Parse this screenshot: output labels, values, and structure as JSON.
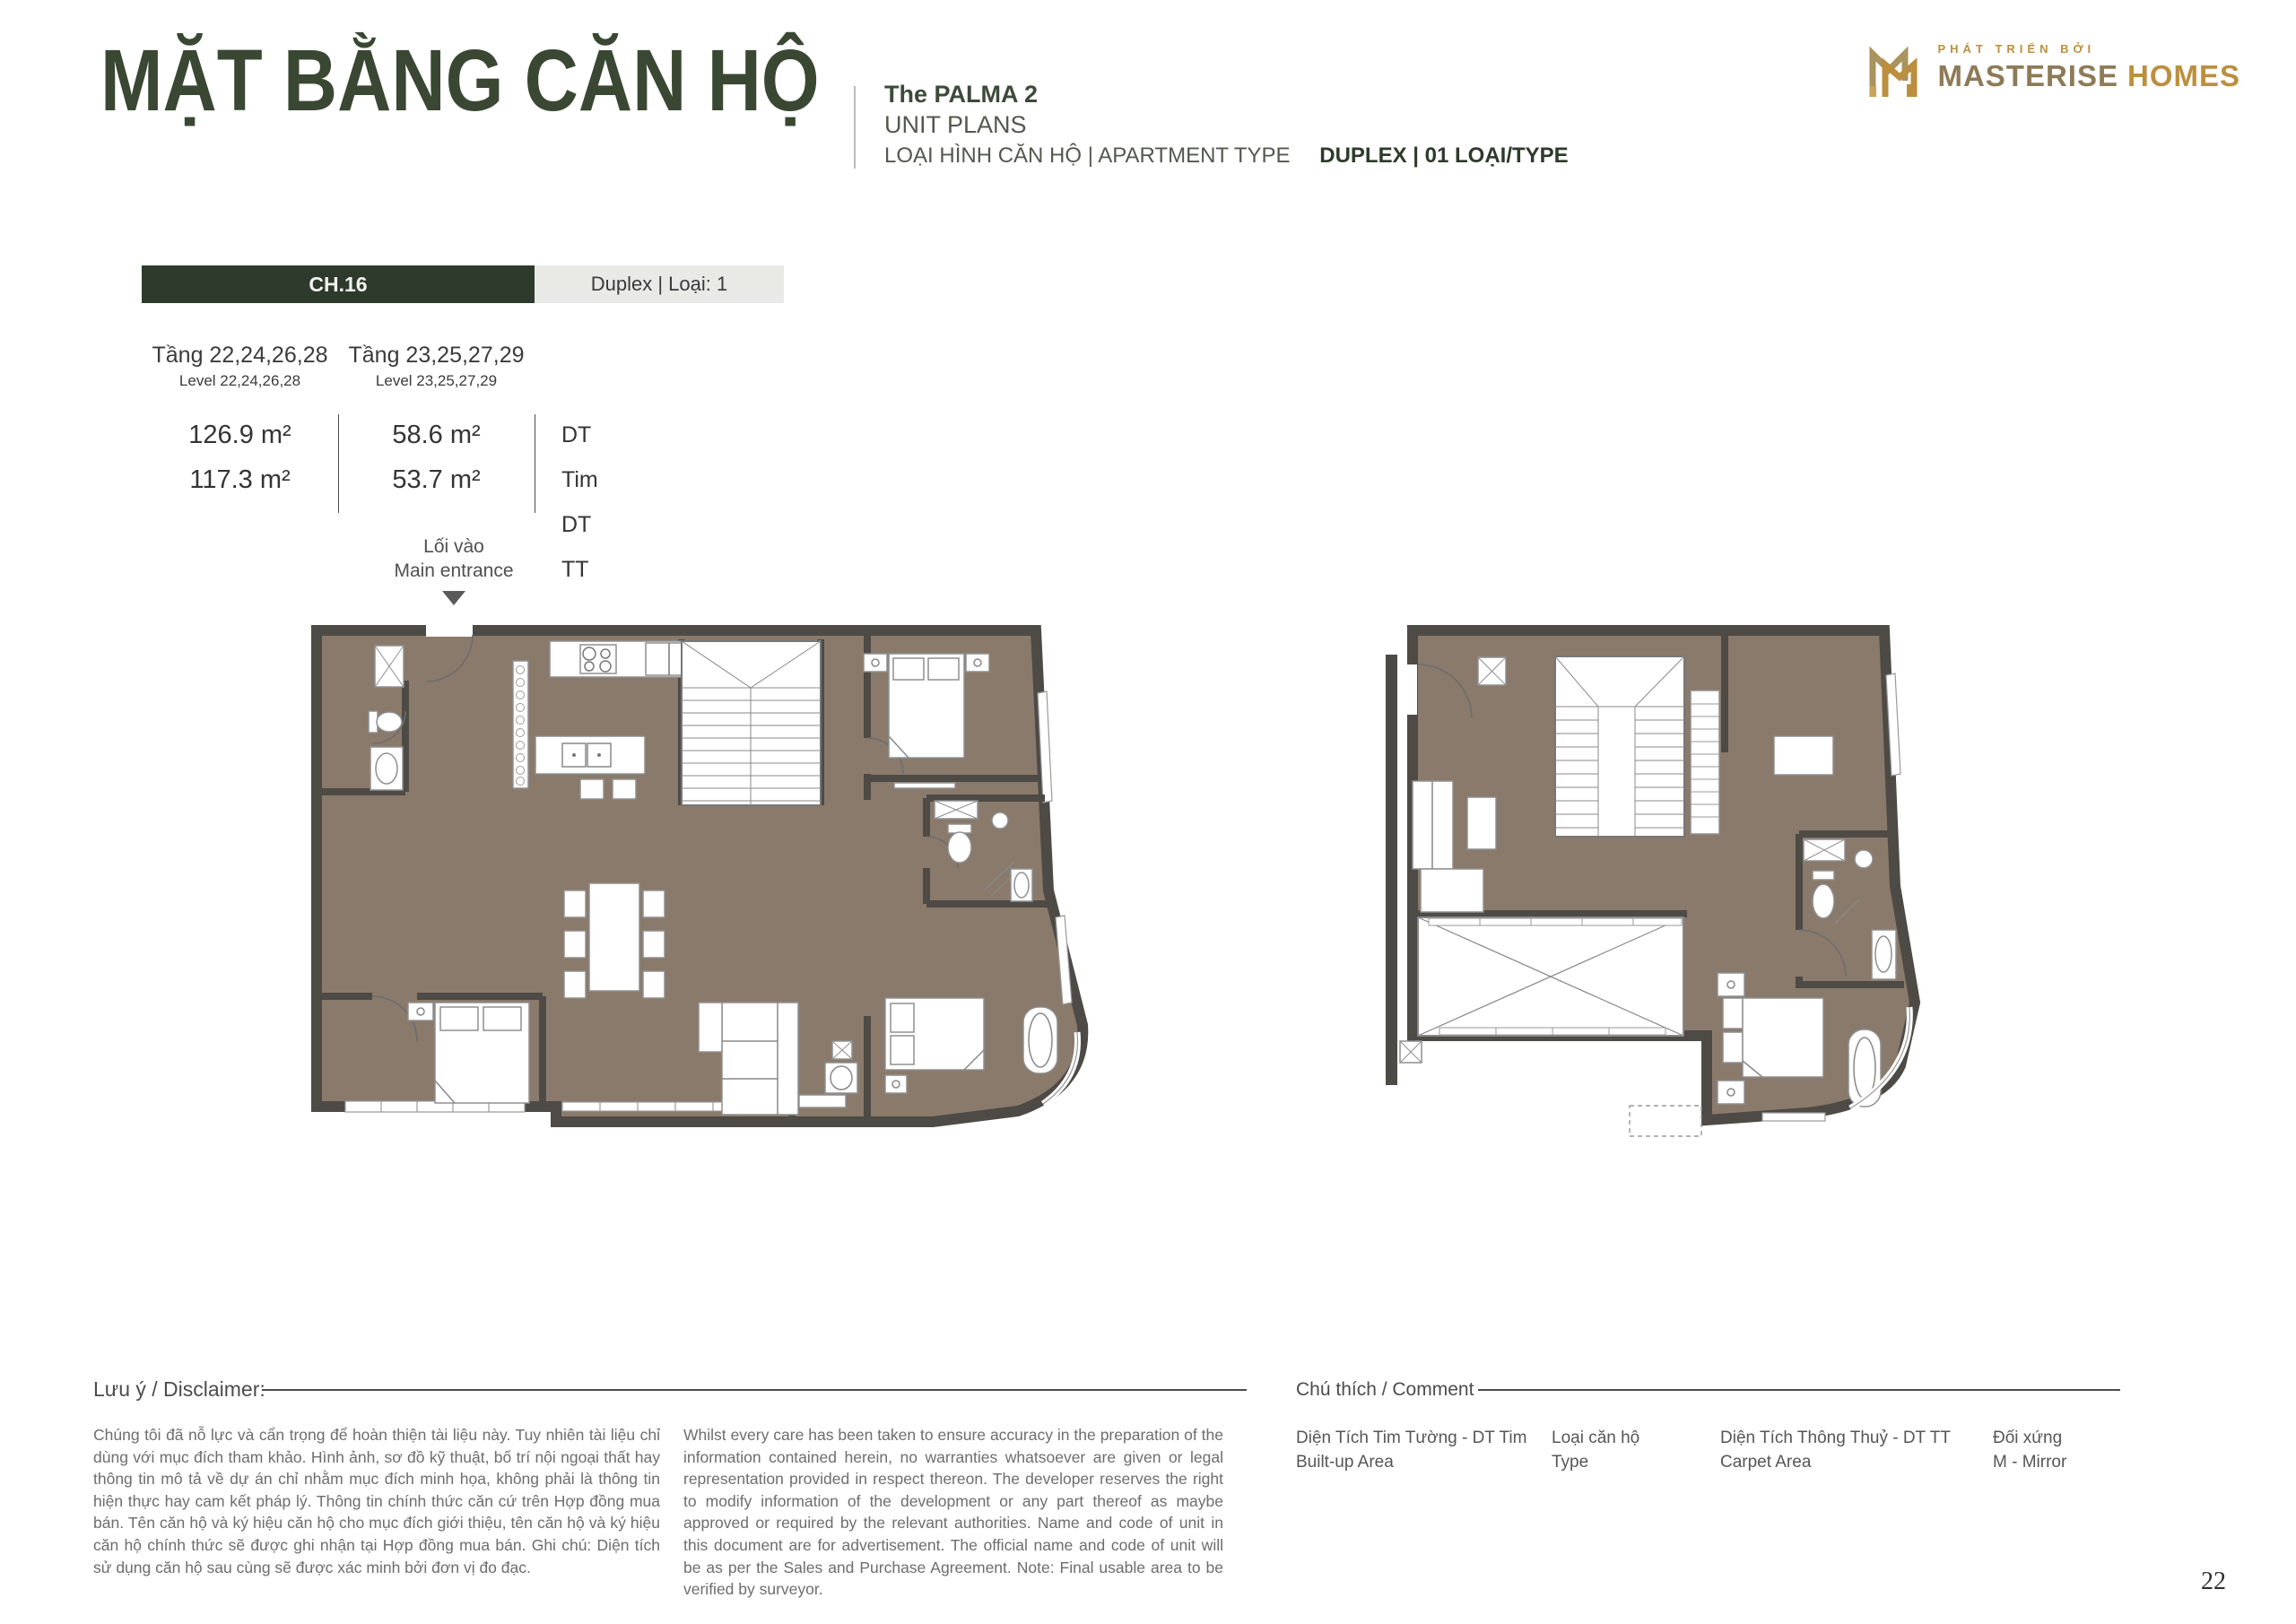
{
  "page": {
    "number": "22"
  },
  "header": {
    "title": "MẶT BẰNG CĂN HỘ",
    "project_name": "The PALMA 2",
    "unit_plans_label": "UNIT PLANS",
    "type_label": "LOẠI HÌNH CĂN HỘ  |  APARTMENT TYPE",
    "type_value": "DUPLEX  |  01 LOẠI/TYPE"
  },
  "logo": {
    "tagline": "PHÁT TRIỂN BỞI",
    "brand_primary": "MASTERISE",
    "brand_secondary": "HOMES"
  },
  "unit_info": {
    "unit_code": "CH.16",
    "unit_type": "Duplex | Loại: 1",
    "levels": [
      {
        "vi": "Tầng 22,24,26,28",
        "en": "Level 22,24,26,28",
        "area_tim": "126.9 m²",
        "area_tt": "117.3 m²"
      },
      {
        "vi": "Tầng 23,25,27,29",
        "en": "Level 23,25,27,29",
        "area_tim": "58.6 m²",
        "area_tt": "53.7 m²"
      }
    ],
    "area_labels": {
      "tim": "DT Tim",
      "tt": "DT TT"
    }
  },
  "entrance": {
    "vi": "Lối vào",
    "en": "Main entrance"
  },
  "disclaimer": {
    "label": "Lưu ý / Disclaimer:",
    "vi": "Chúng tôi đã nỗ lực và cẩn trọng để hoàn thiện tài liệu này. Tuy nhiên tài liệu chỉ dùng với mục đích tham khảo. Hình ảnh, sơ đồ kỹ thuật, bố trí nội ngoại thất hay thông tin mô tả về dự án chỉ nhằm mục đích minh họa, không phải là thông tin hiện thực hay cam kết pháp lý. Thông tin chính thức căn cứ trên Hợp đồng mua bán. Tên căn hộ và ký hiệu căn hộ cho mục đích giới thiệu, tên căn hộ và ký hiệu căn hộ chính thức sẽ được ghi nhận tại Hợp đồng mua bán. Ghi chú: Diện tích sử dụng căn hộ sau cùng sẽ được xác minh bởi đơn vị đo đạc.",
    "en": "Whilst every care has been taken to ensure accuracy in the preparation of the information contained herein, no warranties whatsoever are given or legal representation provided in respect thereon. The developer reserves the right to modify information of the development or any part thereof as maybe approved or required by the relevant authorities. Name and code of unit in this document are for advertisement. The official name and code of unit will be as per the Sales and Purchase Agreement. Note: Final usable area to be verified by surveyor."
  },
  "legend": {
    "label": "Chú thích / Comment",
    "items": [
      {
        "vi": "Diện Tích Tim Tường - DT Tim",
        "en": "Built-up Area"
      },
      {
        "vi": "Loại căn hộ",
        "en": "Type"
      },
      {
        "vi": "Diện Tích Thông Thuỷ - DT TT",
        "en": "Carpet Area"
      },
      {
        "vi": "Đối xứng",
        "en": "M - Mirror"
      }
    ]
  },
  "colors": {
    "accent_green": "#2e3a2b",
    "title_green": "#3a4733",
    "gold": "#bb8f3e",
    "bronze": "#8d7b57",
    "floor": "#8a7a6b",
    "wall": "#4e4a45",
    "light_cell": "#e9e9e6"
  }
}
